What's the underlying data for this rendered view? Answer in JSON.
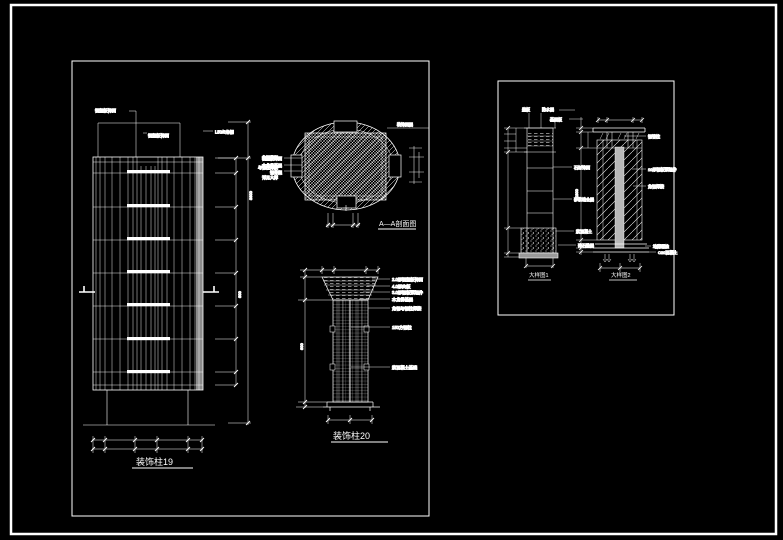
{
  "window": {
    "background": "#000000",
    "line_color": "#ffffff"
  },
  "left_sheet": {
    "elevation": {
      "label_top_1": "铝塑板饰面",
      "label_top_2": "铝塑板饰面",
      "label_angle_steel": "L50/5角钢",
      "notes": [
        "角钢骨架",
        "与钢柱焊接",
        "详见大样"
      ],
      "dim_outer": "3600",
      "dim_inner": "600",
      "title": "装饰柱19"
    },
    "section_aa": {
      "left_labels": [
        "铝塑板饰面",
        "木龙骨基层",
        "钢骨架"
      ],
      "top_right_label": "装饰面层",
      "title": "A—A剖面图"
    },
    "column20": {
      "right_labels": [
        "2.0厚铝塑板饰面",
        "4.0厚夹板",
        "3.0厚钢板预埋件",
        "木龙骨基层",
        "角钢与钢柱焊接",
        "150方钢柱",
        "素混凝土基础"
      ],
      "dim_left": "600",
      "title": "装饰柱20"
    }
  },
  "right_sheet": {
    "detail1": {
      "top_labels": [
        "盖板",
        "防水层",
        "基层板"
      ],
      "right_labels": [
        "石材饰面",
        "砂浆结合层",
        "素混凝土",
        "碎石垫层"
      ],
      "title": "大样图1"
    },
    "detail2": {
      "right_labels": [
        "钢管柱",
        "10厚钢板预埋件",
        "角钢焊接"
      ],
      "bottom_labels": [
        "地脚螺栓",
        "C20混凝土"
      ],
      "dim_left": "1800",
      "title": "大样图2"
    }
  }
}
